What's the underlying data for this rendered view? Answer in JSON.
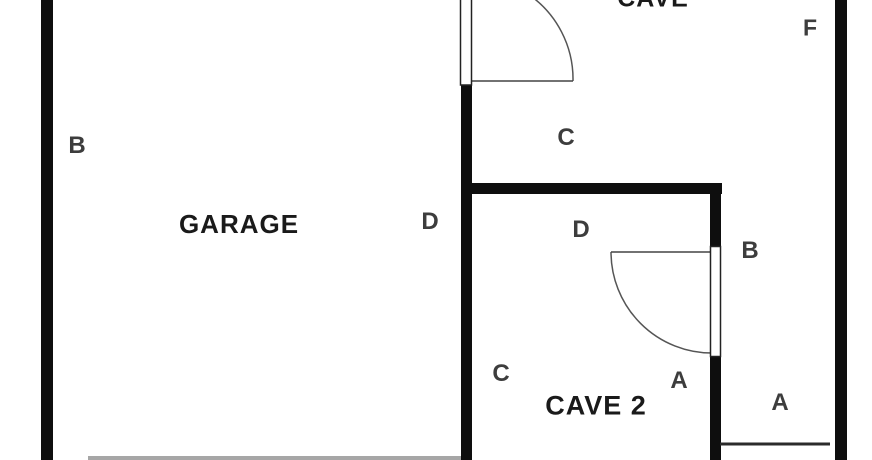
{
  "rooms": {
    "garage": {
      "name": "GARAGE"
    },
    "cave": {
      "name": "CAVE"
    },
    "cave2": {
      "name": "CAVE 2"
    }
  },
  "markers": {
    "garage_b": "B",
    "garage_d": "D",
    "cave_c": "C",
    "cave_f": "F",
    "cave2_d": "D",
    "cave2_b": "B",
    "cave2_c": "C",
    "cave2_a": "A",
    "annex_a": "A"
  },
  "colors": {
    "wall": "#0e0e0e",
    "marker_text": "#3d3d3d",
    "room_text": "#1a1a1a",
    "background": "#ffffff"
  }
}
